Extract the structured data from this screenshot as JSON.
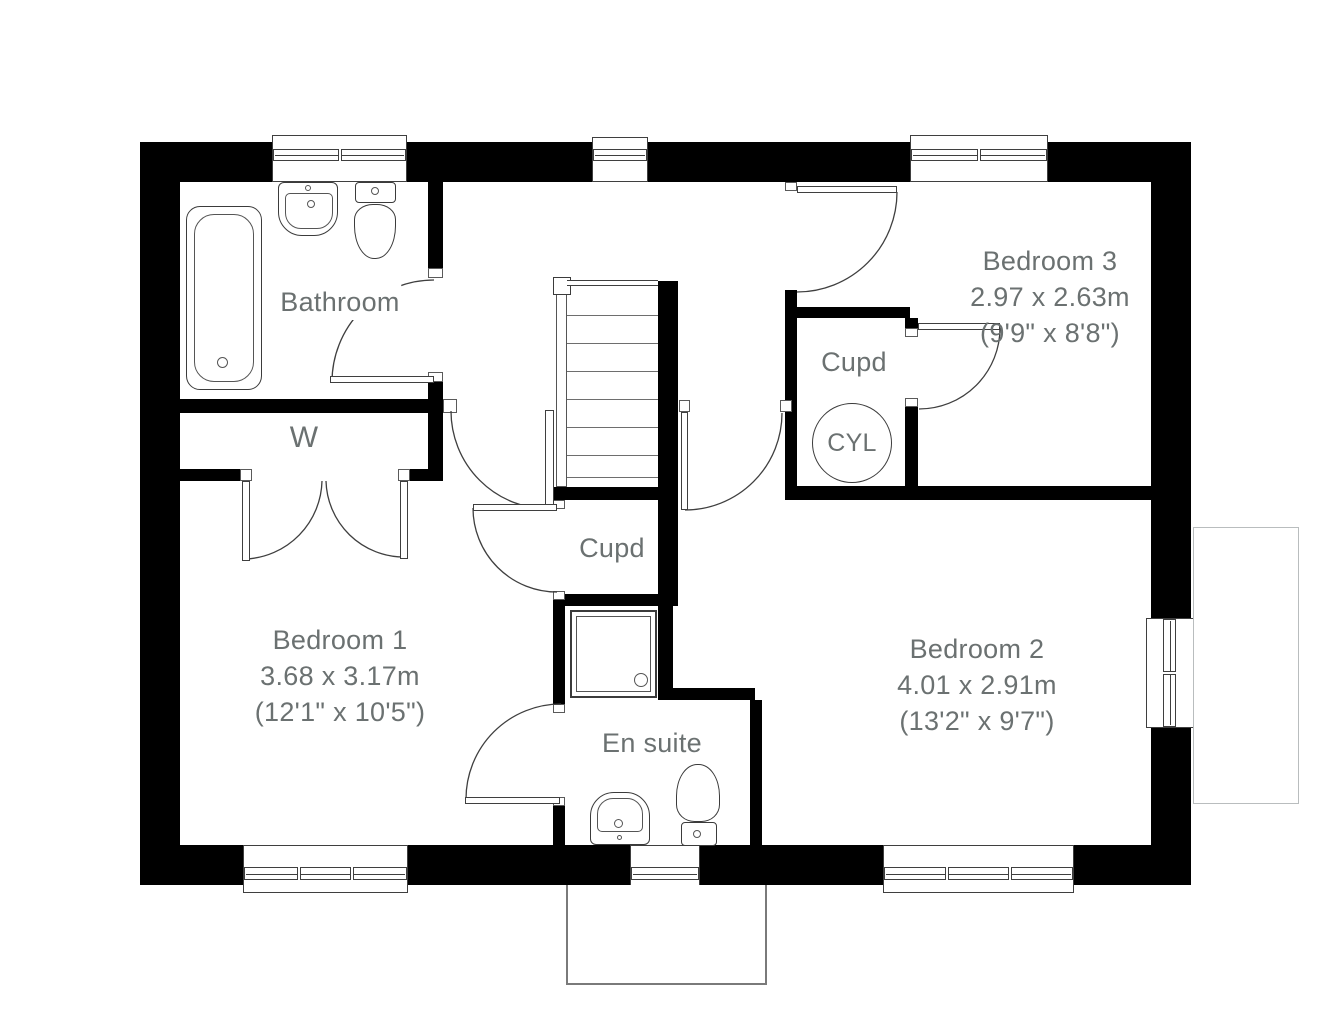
{
  "rooms": {
    "bathroom": {
      "label": "Bathroom"
    },
    "wardrobe": {
      "label": "W"
    },
    "landing_cupboard": {
      "label": "Cupd"
    },
    "cylinder_cupboard": {
      "label": "Cupd",
      "cylinder_label": "CYL"
    },
    "en_suite": {
      "label": "En suite"
    },
    "bedroom_1": {
      "label": "Bedroom 1",
      "size_metric": "3.68 x 3.17m",
      "size_imperial": "(12'1\" x 10'5\")"
    },
    "bedroom_2": {
      "label": "Bedroom 2",
      "size_metric": "4.01 x 2.91m",
      "size_imperial": "(13'2\" x 9'7\")"
    },
    "bedroom_3": {
      "label": "Bedroom 3",
      "size_metric": "2.97 x 2.63m",
      "size_imperial": "(9'9\" x 8'8\")"
    }
  },
  "colors": {
    "wall": "#000000",
    "line": "#3f3f3f",
    "label_text": "#6b7171"
  }
}
